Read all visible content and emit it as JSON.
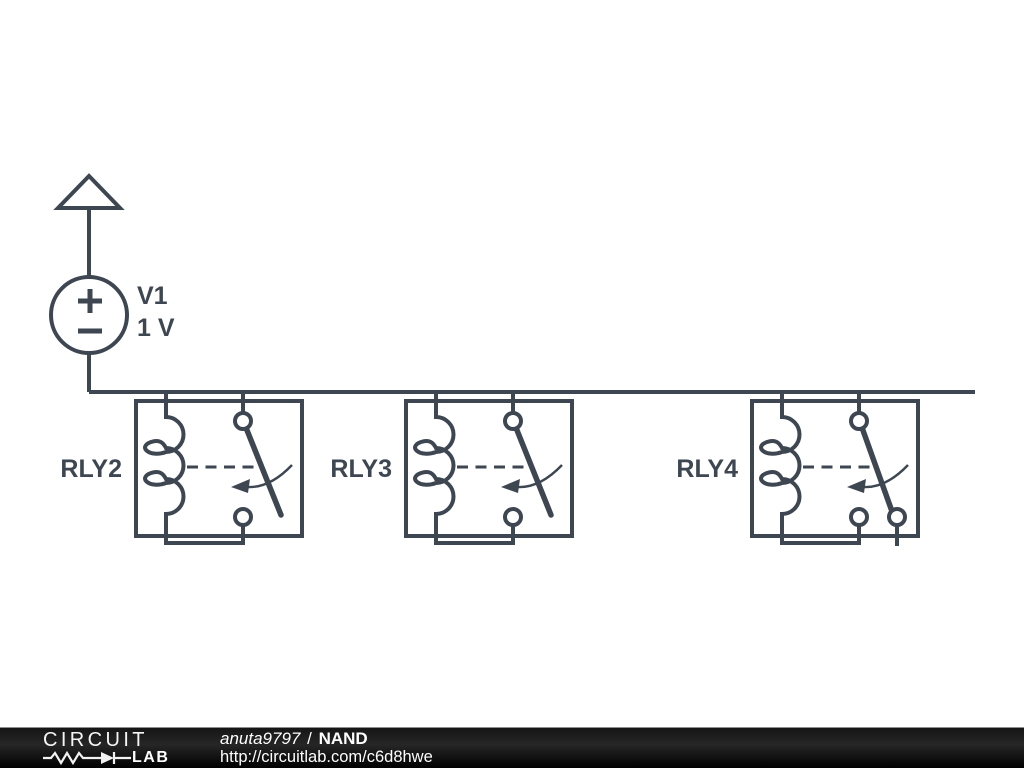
{
  "schematic": {
    "line_color": "#3d4651",
    "background": "#ffffff",
    "source": {
      "name": "V1",
      "value": "1 V",
      "type": "voltage-source",
      "terminal": "vcc-flag"
    },
    "relays": [
      {
        "name": "RLY2",
        "state": "open"
      },
      {
        "name": "RLY3",
        "state": "open"
      },
      {
        "name": "RLY4",
        "state": "closed-to-second-throw"
      }
    ]
  },
  "footer": {
    "bar_color": "#000000",
    "logo": {
      "word_top": "CIRCUIT",
      "word_bottom": "LAB"
    },
    "author": "anuta9797",
    "separator": "/",
    "circuit_title": "NAND",
    "url": "http://circuitlab.com/c6d8hwe"
  }
}
